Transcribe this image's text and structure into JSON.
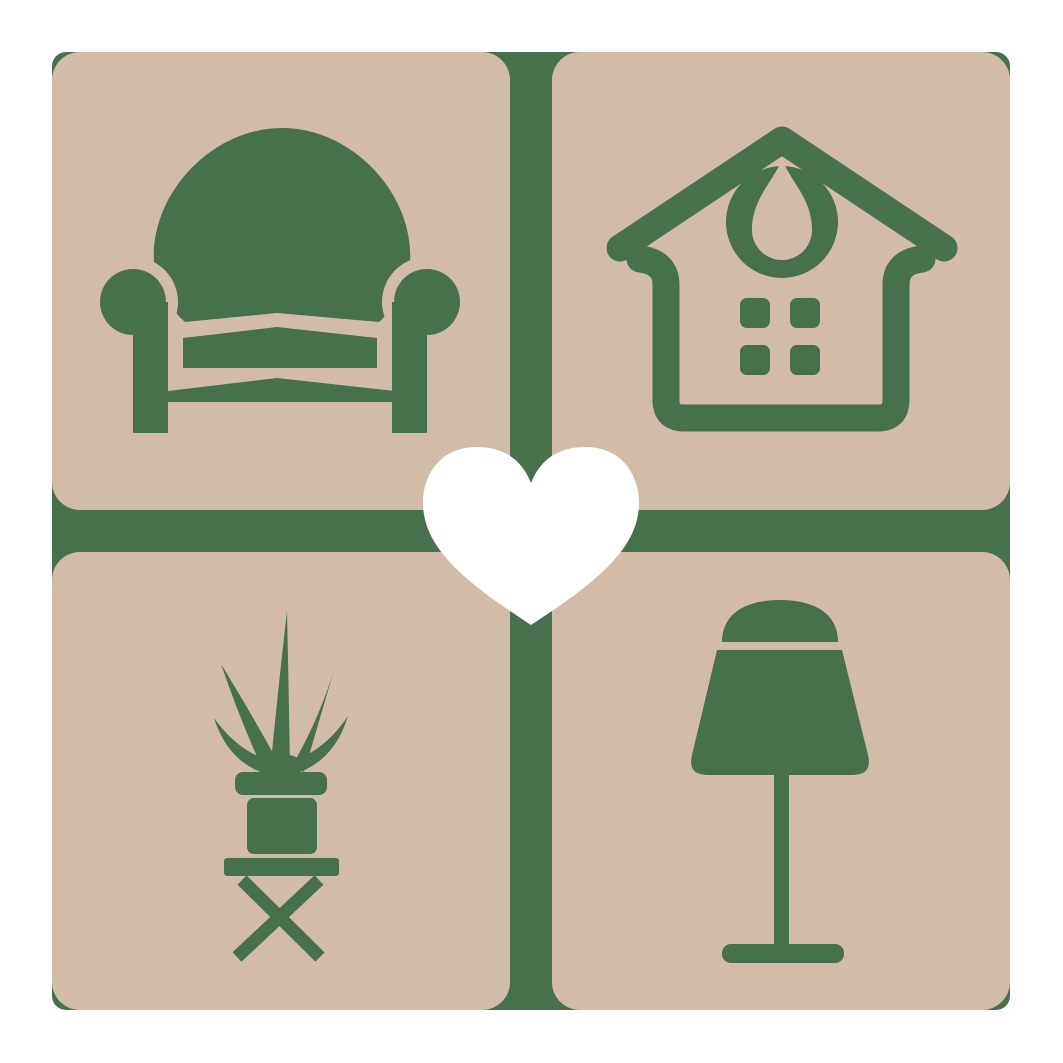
{
  "logo": {
    "description": "Home furnishings logo: four rounded tan tiles on a green backing with furniture icons and a central white heart",
    "colors": {
      "background": "#FFFFFF",
      "frame": "#47704D",
      "tile": "#D3BCA7",
      "icon": "#47704D",
      "heart": "#FFFFFF"
    },
    "tiles": [
      {
        "position": "top-left",
        "icon": "armchair-icon"
      },
      {
        "position": "top-right",
        "icon": "house-icon"
      },
      {
        "position": "bottom-left",
        "icon": "potted-plant-icon"
      },
      {
        "position": "bottom-right",
        "icon": "lamp-icon"
      }
    ],
    "center": {
      "icon": "heart-icon"
    }
  }
}
